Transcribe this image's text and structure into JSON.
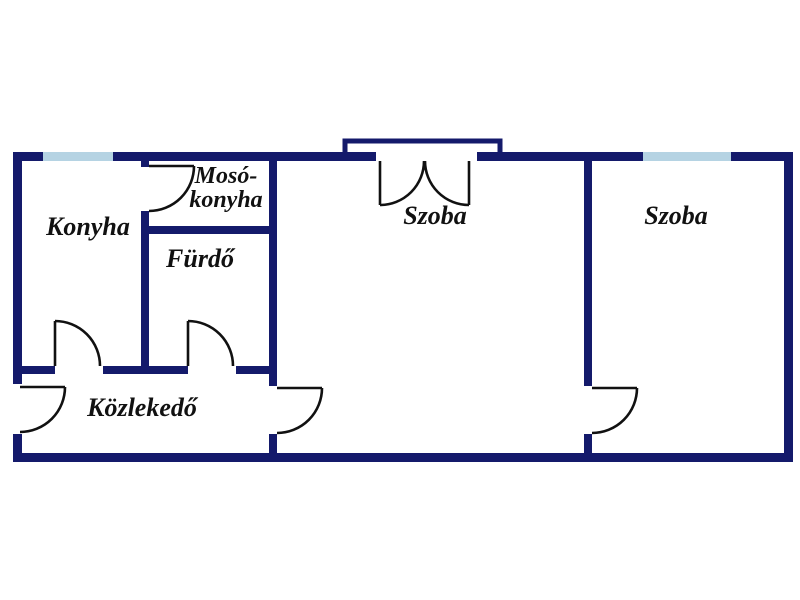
{
  "title": "Lakás alaprajz (apartment floor plan)",
  "colors": {
    "wall": "#141a6b",
    "window": "#b5d3e3",
    "line": "#111111",
    "background": "#ffffff",
    "text": "#111111"
  },
  "rooms": [
    {
      "id": "konyha",
      "label": "Konyha"
    },
    {
      "id": "moso-konyha",
      "label": "Mosó-konyha",
      "line1": "Mosó-",
      "line2": "konyha"
    },
    {
      "id": "furdo",
      "label": "Fürdő"
    },
    {
      "id": "szoba-kozepso",
      "label": "Szoba"
    },
    {
      "id": "szoba-jobb",
      "label": "Szoba"
    },
    {
      "id": "kozlekedo",
      "label": "Közlekedő"
    }
  ],
  "features": {
    "windows": [
      "konyha-window-top",
      "szoba-jobb-window-top"
    ],
    "single_doors": [
      "entry-door-left-wall",
      "konyha-door",
      "furdo-door",
      "moso-konyha-door",
      "kozlekedo-to-szoba-door",
      "szoba-to-szoba-door"
    ],
    "double_doors": [
      "szoba-balcony-double-door"
    ]
  }
}
